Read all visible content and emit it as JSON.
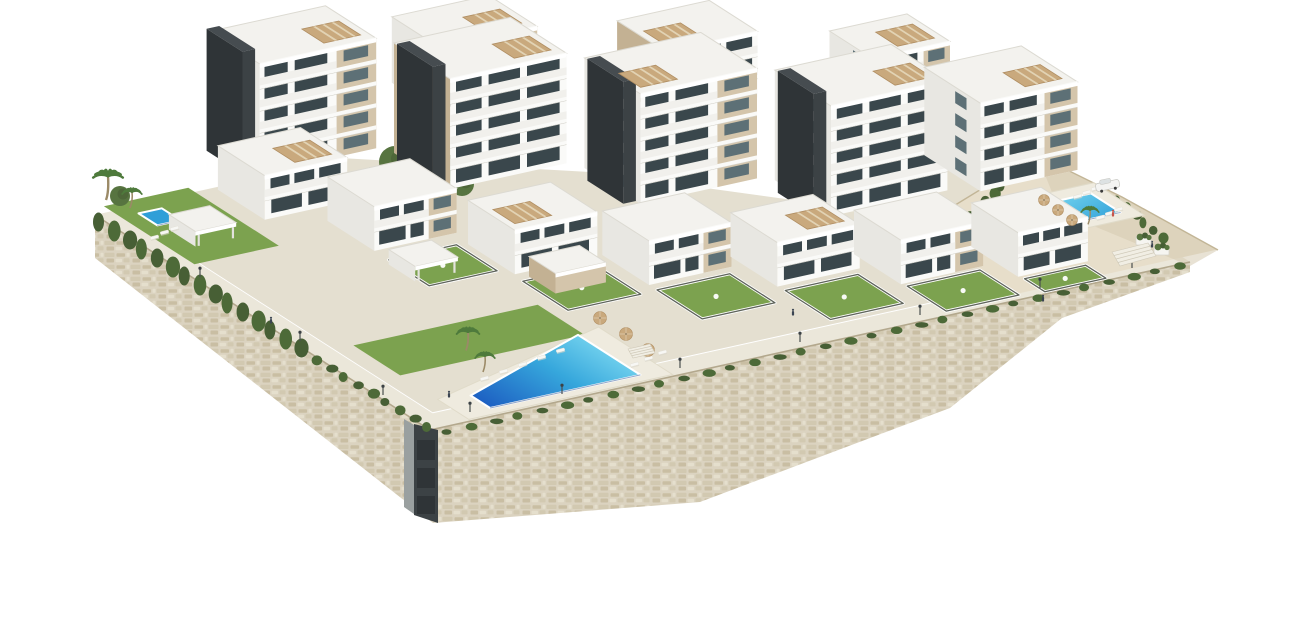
{
  "scene": {
    "description": "aerial-3d-render-of-white-residential-complex-with-pools-gardens-and-stone-retaining-wall",
    "width": 1290,
    "height": 620
  },
  "projection": {
    "ox": 430,
    "oy": 430,
    "ax": 0.97,
    "ay": -0.214,
    "bx": -0.78,
    "by": -0.5
  },
  "colors": {
    "bg": "#ffffff",
    "stone_base": "#dbd3c0",
    "stone_dark": "#c8bca0",
    "stone_mid": "#d2c8af",
    "stone_light": "#e7e0cf",
    "wall_cap": "#b3a88d",
    "pavement": "#ebe7da",
    "pavement2": "#e4dfd0",
    "sand": "#e7deca",
    "sand_shadow": "#d6cab0",
    "cliff_line": "#c2b596",
    "lawn": "#7ca24f",
    "lawn_dark": "#6a9142",
    "garden_cap": "#5f645b",
    "garden_wall": "#ffffff",
    "hedge": "#4d6a38",
    "tree": "#577440",
    "tree_dark": "#475f35",
    "palm": "#4e7a3c",
    "palm_trunk": "#9b8a67",
    "white_wall": "#fafaf8",
    "white_side": "#e8e7e2",
    "parapet": "#f1f0ec",
    "roof": "#f3f2ee",
    "roof_edge": "#dcdad2",
    "slab_line": "#d2d0c8",
    "beige": "#d4c5ab",
    "beige_dark": "#c3b193",
    "core": "#3c4245",
    "core_side": "#2f3437",
    "core_roof": "#464c50",
    "window": "#3a474c",
    "window_light": "#5d7076",
    "pool_deep": "#1d5fc2",
    "pool_mid": "#2f9fd8",
    "pool_light": "#7fdcf2",
    "pool_edge": "#15408a",
    "deck": "#efebdf",
    "deck_edge": "#e0dbc9",
    "parasol": "#c9a97d",
    "parasol_edge": "#b08e62",
    "lounger": "#f7f7f4",
    "lounger_shadow": "#d9d5c9",
    "metal": "#4a4f4f",
    "people": "#3b4552",
    "people_red": "#c7544a",
    "car_body": "#f4f4f2",
    "car_glass": "#dde2e3",
    "car_line": "#c6c6c0",
    "wheel": "#3a3a3a",
    "planter": "#f6f5f1",
    "stair": "#f1eee4",
    "stair_line": "#cfc9b8"
  },
  "terrain": {
    "patches": [
      {
        "id": "walkway-west",
        "pts": [
          [
            0,
            0
          ],
          [
            22,
            0
          ],
          [
            22,
            430
          ],
          [
            0,
            430
          ]
        ],
        "z": 0,
        "fill": "pavement"
      },
      {
        "id": "promenade-south",
        "pts": [
          [
            0,
            0
          ],
          [
            784,
            0
          ],
          [
            784,
            24
          ],
          [
            0,
            24
          ]
        ],
        "z": 0,
        "fill": "pavement"
      },
      {
        "id": "upper-terraces",
        "pts": [
          [
            22,
            24
          ],
          [
            784,
            24
          ],
          [
            795,
            215
          ],
          [
            560,
            215
          ],
          [
            430,
            330
          ],
          [
            260,
            430
          ],
          [
            22,
            430
          ]
        ],
        "z": 1,
        "fill": "pavement2"
      },
      {
        "id": "sand-terrace",
        "pts": [
          [
            600,
            10
          ],
          [
            820,
            10
          ],
          [
            810,
            120
          ],
          [
            795,
            210
          ],
          [
            640,
            150
          ]
        ],
        "z": 0,
        "fill": "sand"
      }
    ],
    "cliff_shade": [
      [
        1037,
        155
      ],
      [
        1122,
        197
      ],
      [
        1218,
        250
      ],
      [
        1190,
        266
      ],
      [
        1060,
        212
      ]
    ],
    "cliff_line": [
      [
        934,
        218
      ],
      [
        1037,
        155
      ],
      [
        1122,
        197
      ],
      [
        1218,
        250
      ]
    ]
  },
  "walls": {
    "west_face": [
      [
        95,
        215
      ],
      [
        430,
        430
      ],
      [
        433,
        523
      ],
      [
        95,
        258
      ]
    ],
    "east_face": [
      [
        430,
        430
      ],
      [
        1190,
        262
      ],
      [
        1190,
        272
      ],
      [
        1062,
        318
      ],
      [
        950,
        408
      ],
      [
        700,
        502
      ],
      [
        433,
        523
      ]
    ],
    "cap_lines": [
      [
        [
          95,
          215
        ],
        [
          430,
          430
        ]
      ],
      [
        [
          430,
          430
        ],
        [
          1190,
          262
        ]
      ]
    ],
    "corner_light": [
      [
        404,
        419
      ],
      [
        414,
        425
      ],
      [
        414,
        514
      ],
      [
        404,
        507
      ]
    ],
    "corner_dark": [
      [
        414,
        424
      ],
      [
        438,
        430
      ],
      [
        438,
        523
      ],
      [
        414,
        515
      ]
    ],
    "corner_blocks": [
      [
        417,
        440,
        18,
        20
      ],
      [
        417,
        468,
        18,
        20
      ],
      [
        417,
        496,
        18,
        18
      ]
    ]
  },
  "greens": {
    "lawns": [
      {
        "id": "left-garden-lawn",
        "pts": [
          [
            8,
            312
          ],
          [
            95,
            312
          ],
          [
            95,
            428
          ],
          [
            8,
            428
          ]
        ],
        "z": 8
      },
      {
        "id": "central-lawn",
        "pts": [
          [
            40,
            88
          ],
          [
            230,
            88
          ],
          [
            230,
            148
          ],
          [
            40,
            148
          ]
        ],
        "z": 2
      }
    ],
    "gardens": [
      {
        "id": "garden-villa-2",
        "pts": [
          [
            160,
            200
          ],
          [
            230,
            200
          ],
          [
            230,
            252
          ],
          [
            160,
            252
          ]
        ],
        "z": 10
      },
      {
        "id": "garden-villa-3",
        "pts": [
          [
            242,
            124
          ],
          [
            317,
            124
          ],
          [
            317,
            182
          ],
          [
            242,
            182
          ]
        ],
        "z": 6
      },
      {
        "id": "garden-villa-4",
        "pts": [
          [
            337,
            70
          ],
          [
            412,
            70
          ],
          [
            412,
            128
          ],
          [
            337,
            128
          ]
        ],
        "z": 4
      },
      {
        "id": "garden-villa-5",
        "pts": [
          [
            437,
            30
          ],
          [
            512,
            30
          ],
          [
            512,
            88
          ],
          [
            437,
            88
          ]
        ],
        "z": 2
      },
      {
        "id": "garden-villa-6",
        "pts": [
          [
            537,
            6
          ],
          [
            612,
            6
          ],
          [
            612,
            56
          ],
          [
            537,
            56
          ]
        ],
        "z": 1
      },
      {
        "id": "garden-villa-7",
        "pts": [
          [
            637,
            4
          ],
          [
            700,
            4
          ],
          [
            700,
            30
          ],
          [
            637,
            30
          ]
        ],
        "z": 0
      }
    ],
    "trees": [
      {
        "x": 395,
        "y": 162,
        "r": 16
      },
      {
        "x": 420,
        "y": 146,
        "r": 13
      },
      {
        "x": 443,
        "y": 168,
        "r": 15
      },
      {
        "x": 462,
        "y": 184,
        "r": 12
      },
      {
        "x": 372,
        "y": 178,
        "r": 11
      },
      {
        "x": 120,
        "y": 196,
        "r": 10
      }
    ],
    "tuft_rows": [
      {
        "id": "cypress-row-west",
        "from": [
          100,
          222
        ],
        "to": [
          300,
          348
        ],
        "n": 15,
        "rx": 5.5,
        "ry": 9.5
      },
      {
        "id": "wall-cover-west",
        "from": [
          303,
          352
        ],
        "to": [
          428,
          427
        ],
        "n": 10,
        "rx": 4.5,
        "ry": 4
      },
      {
        "id": "wall-cover-east",
        "from": [
          448,
          432
        ],
        "to": [
          1180,
          266
        ],
        "n": 32,
        "rx": 5,
        "ry": 2.8
      },
      {
        "id": "hedge-sand-west",
        "from": [
          952,
          232
        ],
        "to": [
          1002,
          186
        ],
        "n": 7,
        "rx": 4,
        "ry": 5.5
      },
      {
        "id": "hedge-sand-east",
        "from": [
          1118,
          200
        ],
        "to": [
          1162,
          238
        ],
        "n": 6,
        "rx": 3.5,
        "ry": 4.5
      }
    ]
  },
  "pools": [
    {
      "id": "main-pool",
      "deck": [
        [
          40,
          0
        ],
        [
          250,
          0
        ],
        [
          250,
          95
        ],
        [
          40,
          40
        ]
      ],
      "water": [
        [
          70,
          10
        ],
        [
          225,
          10
        ],
        [
          225,
          90
        ],
        [
          70,
          35
        ]
      ],
      "z": 2,
      "grad": "gradC"
    },
    {
      "id": "right-pool",
      "deck": [
        [
          715,
          85
        ],
        [
          805,
          85
        ],
        [
          805,
          150
        ],
        [
          715,
          150
        ]
      ],
      "water": [
        [
          725,
          97
        ],
        [
          790,
          97
        ],
        [
          790,
          135
        ],
        [
          725,
          135
        ]
      ],
      "z": 0,
      "grad": "gradR"
    },
    {
      "id": "left-plunge-pool",
      "water": [
        [
          26,
          382
        ],
        [
          50,
          382
        ],
        [
          50,
          406
        ],
        [
          26,
          406
        ]
      ],
      "z": 8,
      "flat": true
    }
  ],
  "buildings": [
    {
      "id": "back-block-1",
      "a": 300,
      "da": 100,
      "b": 360,
      "db": 62,
      "z": 72,
      "fl": 3,
      "beige": true,
      "pergola": true
    },
    {
      "id": "back-block-2",
      "a": 480,
      "da": 95,
      "b": 295,
      "db": 62,
      "z": 62,
      "fl": 3,
      "pergola": true,
      "sideBeige": true,
      "pl": true
    },
    {
      "id": "back-block-3",
      "a": 645,
      "da": 80,
      "b": 235,
      "db": 55,
      "z": 50,
      "fl": 3,
      "beige": true,
      "pergola": true
    },
    {
      "id": "tower-1",
      "a": 110,
      "da": 120,
      "b": 355,
      "db": 65,
      "z": 55,
      "fl": 5,
      "core": true,
      "beige": true,
      "pergola": true
    },
    {
      "id": "tower-2",
      "a": 250,
      "da": 120,
      "b": 285,
      "db": 72,
      "z": 45,
      "fl": 5,
      "core": true,
      "pergola": true,
      "sideBeige": true
    },
    {
      "id": "tower-3",
      "a": 390,
      "da": 120,
      "b": 215,
      "db": 72,
      "z": 35,
      "fl": 5,
      "core": true,
      "beige": true,
      "pergola": true,
      "pl": true
    },
    {
      "id": "tower-4",
      "a": 530,
      "da": 120,
      "b": 145,
      "db": 72,
      "z": 28,
      "fl": 5,
      "core": true,
      "pergola": true
    },
    {
      "id": "tower-5",
      "a": 660,
      "da": 100,
      "b": 115,
      "db": 72,
      "z": 40,
      "fl": 4,
      "beige": true,
      "pergola": true
    },
    {
      "id": "villa-1",
      "a": 95,
      "da": 85,
      "b": 330,
      "db": 60,
      "z": 25,
      "fl": 2,
      "pergola": true
    },
    {
      "id": "villa-2",
      "a": 150,
      "da": 85,
      "b": 258,
      "db": 60,
      "z": 18,
      "fl": 2,
      "beige": true
    },
    {
      "id": "villa-3",
      "a": 237,
      "da": 85,
      "b": 186,
      "db": 60,
      "z": 12,
      "fl": 2,
      "pergola": true,
      "pl": true
    },
    {
      "id": "villa-4",
      "a": 332,
      "da": 85,
      "b": 132,
      "db": 60,
      "z": 8,
      "fl": 2,
      "beige": true
    },
    {
      "id": "villa-5",
      "a": 432,
      "da": 85,
      "b": 92,
      "db": 60,
      "z": 5,
      "fl": 2,
      "pergola": true
    },
    {
      "id": "villa-6",
      "a": 532,
      "da": 85,
      "b": 58,
      "db": 60,
      "z": 3,
      "fl": 2,
      "beige": true
    },
    {
      "id": "villa-7",
      "a": 632,
      "da": 72,
      "b": 32,
      "db": 60,
      "z": 2,
      "fl": 2
    },
    {
      "id": "spa-annex",
      "a": 250,
      "da": 52,
      "b": 150,
      "db": 34,
      "z": 8,
      "fl": 1,
      "fh": 20,
      "solidBeige": true
    },
    {
      "id": "pergola-west-garden",
      "a": 30,
      "da": 42,
      "b": 338,
      "db": 34,
      "z": 8,
      "open": true
    },
    {
      "id": "pergola-villa-2",
      "a": 152,
      "da": 44,
      "b": 208,
      "db": 34,
      "z": 12,
      "open": true
    }
  ],
  "details": {
    "loungers": [
      {
        "x": 480,
        "y": 378
      },
      {
        "x": 499,
        "y": 371
      },
      {
        "x": 518,
        "y": 364
      },
      {
        "x": 537,
        "y": 357
      },
      {
        "x": 556,
        "y": 350
      },
      {
        "x": 630,
        "y": 364
      },
      {
        "x": 644,
        "y": 358
      },
      {
        "x": 658,
        "y": 352
      },
      {
        "x": 1073,
        "y": 196
      },
      {
        "x": 1082,
        "y": 192
      },
      {
        "x": 1091,
        "y": 188
      },
      {
        "x": 1100,
        "y": 184
      },
      {
        "x": 1096,
        "y": 217
      },
      {
        "x": 1105,
        "y": 213
      },
      {
        "x": 1114,
        "y": 209
      },
      {
        "x": 150,
        "y": 237
      },
      {
        "x": 160,
        "y": 232
      },
      {
        "x": 170,
        "y": 228
      }
    ],
    "parasols": [
      {
        "x": 600,
        "y": 318,
        "r": 6.5
      },
      {
        "x": 626,
        "y": 334,
        "r": 6.5
      },
      {
        "x": 648,
        "y": 350,
        "r": 6.5
      },
      {
        "x": 1044,
        "y": 200,
        "r": 5.5
      },
      {
        "x": 1058,
        "y": 210,
        "r": 5.5
      },
      {
        "x": 1072,
        "y": 220,
        "r": 5.5
      }
    ],
    "lamps": [
      {
        "x": 200,
        "y": 277
      },
      {
        "x": 300,
        "y": 341
      },
      {
        "x": 383,
        "y": 395
      },
      {
        "x": 470,
        "y": 412
      },
      {
        "x": 562,
        "y": 394
      },
      {
        "x": 680,
        "y": 368
      },
      {
        "x": 800,
        "y": 342
      },
      {
        "x": 920,
        "y": 315
      },
      {
        "x": 1040,
        "y": 288
      },
      {
        "x": 1132,
        "y": 268
      }
    ],
    "people": [
      {
        "x": 1113,
        "y": 212,
        "red": true
      },
      {
        "x": 1124,
        "y": 258
      },
      {
        "x": 1043,
        "y": 297
      },
      {
        "x": 793,
        "y": 311
      },
      {
        "x": 449,
        "y": 393
      },
      {
        "x": 271,
        "y": 319
      },
      {
        "x": 1152,
        "y": 243
      }
    ],
    "planters": [
      {
        "x": 1136,
        "y": 236
      },
      {
        "x": 1154,
        "y": 246
      }
    ],
    "stairs": [
      {
        "id": "stairs-east",
        "pts": [
          [
            1112,
            252
          ],
          [
            1148,
            243
          ],
          [
            1156,
            256
          ],
          [
            1120,
            266
          ]
        ]
      },
      {
        "id": "stairs-central",
        "pts": [
          [
            628,
            349
          ],
          [
            650,
            344
          ],
          [
            655,
            353
          ],
          [
            633,
            358
          ]
        ]
      }
    ],
    "car": {
      "x": 1095,
      "y": 184
    },
    "palms": [
      {
        "x": 106,
        "y": 176,
        "s": 1.5
      },
      {
        "x": 130,
        "y": 192,
        "s": 1.0
      },
      {
        "x": 466,
        "y": 332,
        "s": 1.15
      },
      {
        "x": 483,
        "y": 356,
        "s": 1.0
      },
      {
        "x": 1088,
        "y": 210,
        "s": 0.9
      }
    ]
  }
}
